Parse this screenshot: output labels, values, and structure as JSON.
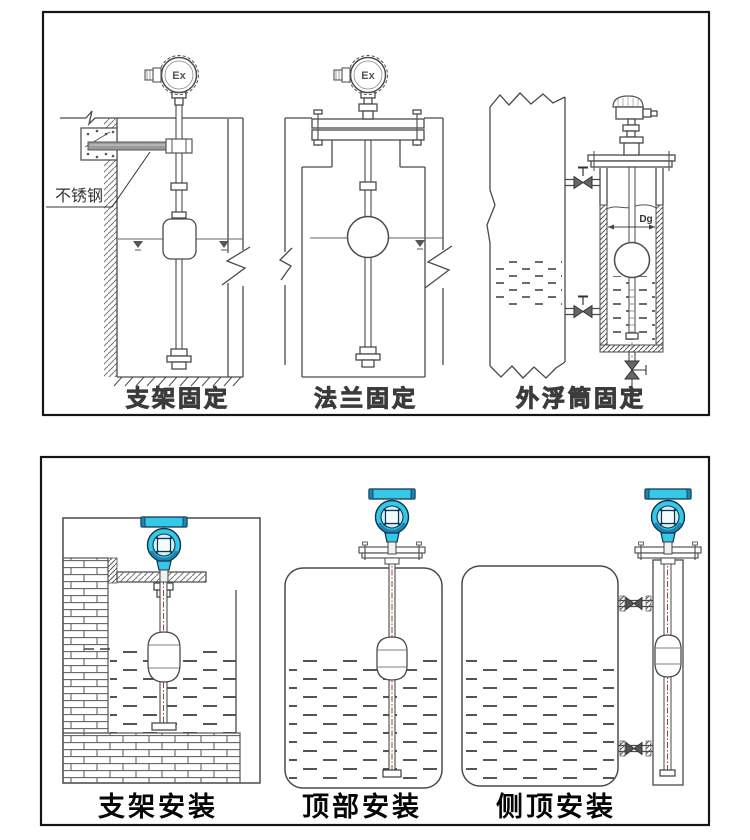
{
  "top_panel": {
    "captions": {
      "c1": "支架固定",
      "c2": "法兰固定",
      "c3": "外浮筒固定"
    },
    "labels": {
      "stainless": "不锈钢",
      "ex1": "Ex",
      "ex2": "Ex",
      "dg": "Dg"
    }
  },
  "bottom_panel": {
    "captions": {
      "c1": "支架安装",
      "c2": "顶部安装",
      "c3": "侧顶安装"
    }
  },
  "colors": {
    "panel_border": "#151515",
    "line": "#4a4a4a",
    "transmitter_body": "#35c8e8",
    "transmitter_shadow": "#1b86b4",
    "rod_centerline": "#9c4632",
    "caption_outline": "#3b3b3b"
  }
}
